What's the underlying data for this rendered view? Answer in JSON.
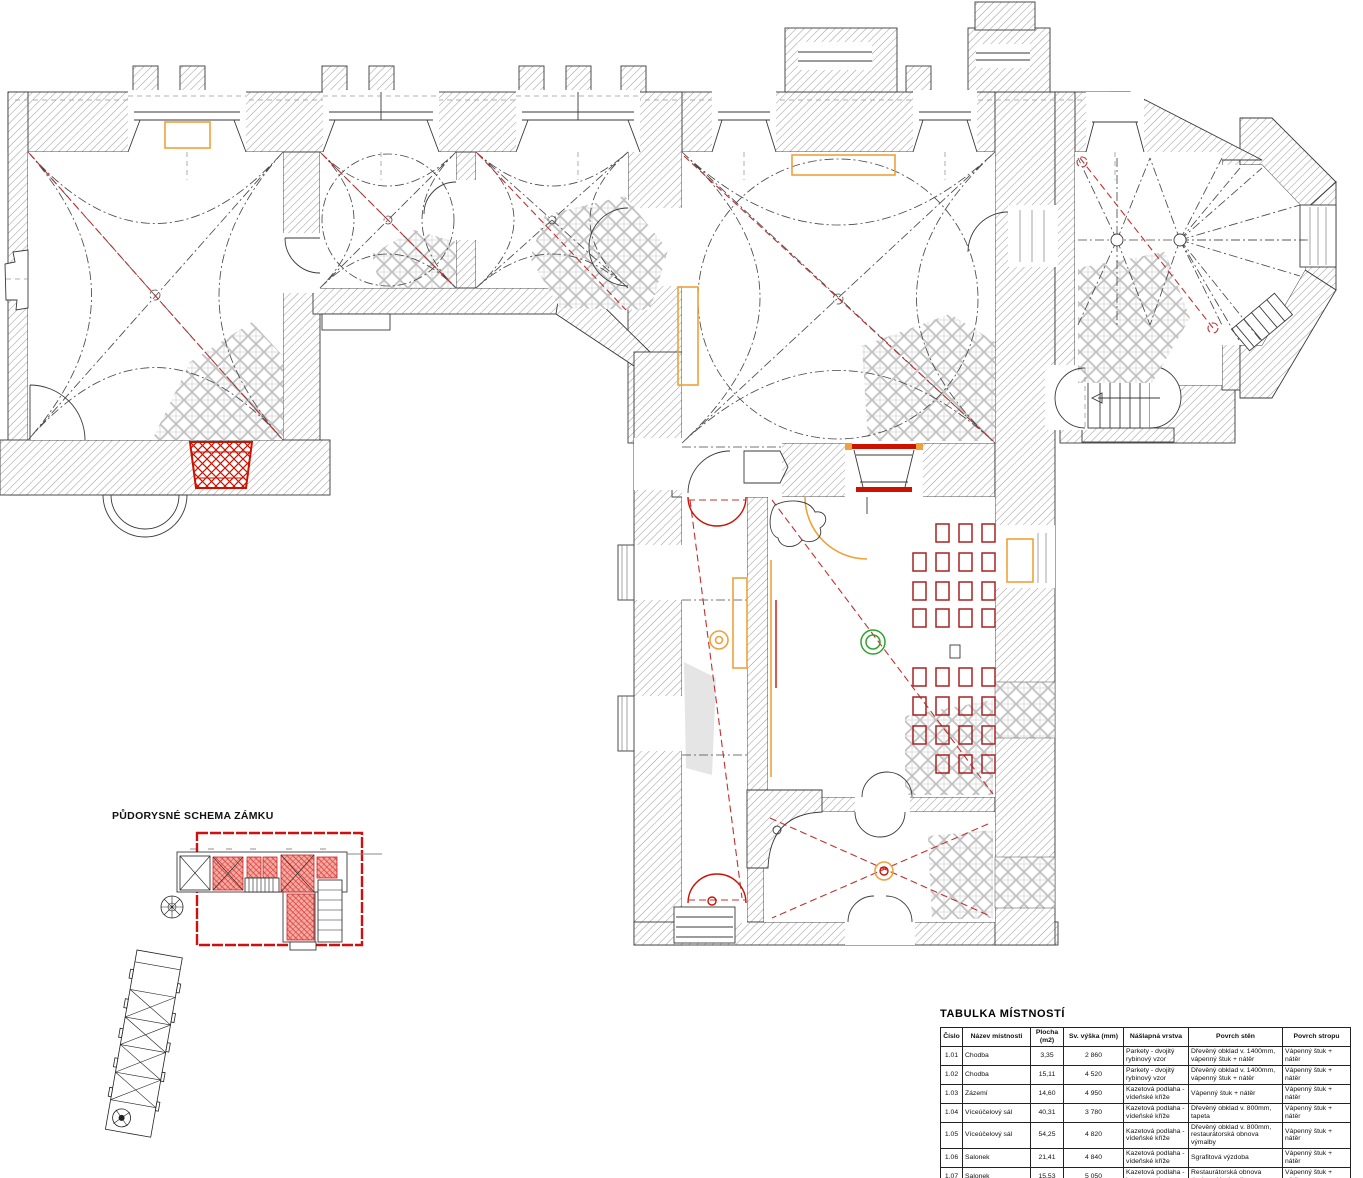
{
  "schema": {
    "label": "PŮDORYSNÉ SCHEMA ZÁMKU"
  },
  "table": {
    "title": "TABULKA MÍSTNOSTÍ",
    "headers": [
      "Číslo",
      "Název místnosti",
      "Plocha (m2)",
      "Sv. výška (mm)",
      "Nášlapná vrstva",
      "Povrch stěn",
      "Povrch stropu"
    ],
    "rows": [
      [
        "1.01",
        "Chodba",
        "3,35",
        "2 860",
        "Parkety - dvojitý rybinový vzor",
        "Dřevěný obklad v. 1400mm, vápenný štuk + nátěr",
        "Vápenný štuk + nátěr"
      ],
      [
        "1.02",
        "Chodba",
        "15,11",
        "4 520",
        "Parkety - dvojitý rybinový vzor",
        "Dřevěný obklad v. 1400mm, vápenný štuk + nátěr",
        "Vápenný štuk + nátěr"
      ],
      [
        "1.03",
        "Zázemí",
        "14,60",
        "4 950",
        "Kazetová podlaha - vídeňské kříže",
        "Vápenný štuk + nátěr",
        "Vápenný štuk + nátěr"
      ],
      [
        "1.04",
        "Víceúčelový sál",
        "40,31",
        "3 780",
        "Kazetová podlaha - vídeňské kříže",
        "Dřevěný obklad v. 800mm, tapeta",
        "Vápenný štuk + nátěr"
      ],
      [
        "1.05",
        "Víceúčelový sál",
        "54,25",
        "4 820",
        "Kazetová podlaha - vídeňské kříže",
        "Dřevěný obklad v. 800mm, restaurátorská obnova výmalby",
        "Vápenný štuk + nátěr"
      ],
      [
        "1.06",
        "Salonek",
        "21,41",
        "4 840",
        "Kazetová podlaha - vídeňské kříže",
        "Sgrafitová výzdoba",
        "Vápenný štuk + nátěr"
      ],
      [
        "1.07",
        "Salonek",
        "15,53",
        "5 050",
        "Kazetová podlaha - intarzovaná",
        "Restaurátorská obnova dochovalé výmalby",
        "Vápenný štuk + nátěr"
      ],
      [
        "",
        "",
        "",
        "",
        "Kazetová podlaha -",
        "Restaurátorská obnova",
        ""
      ]
    ]
  },
  "colors": {
    "accent_red": "#c03030",
    "deep_red": "#cc1100",
    "chair_red": "#a82222",
    "accent_orange": "#efa23a",
    "accent_green": "#2fa32f",
    "tile_gray": "#c6c6c6",
    "line_dark": "#3a3a3a",
    "schema_red": "#d01010"
  }
}
